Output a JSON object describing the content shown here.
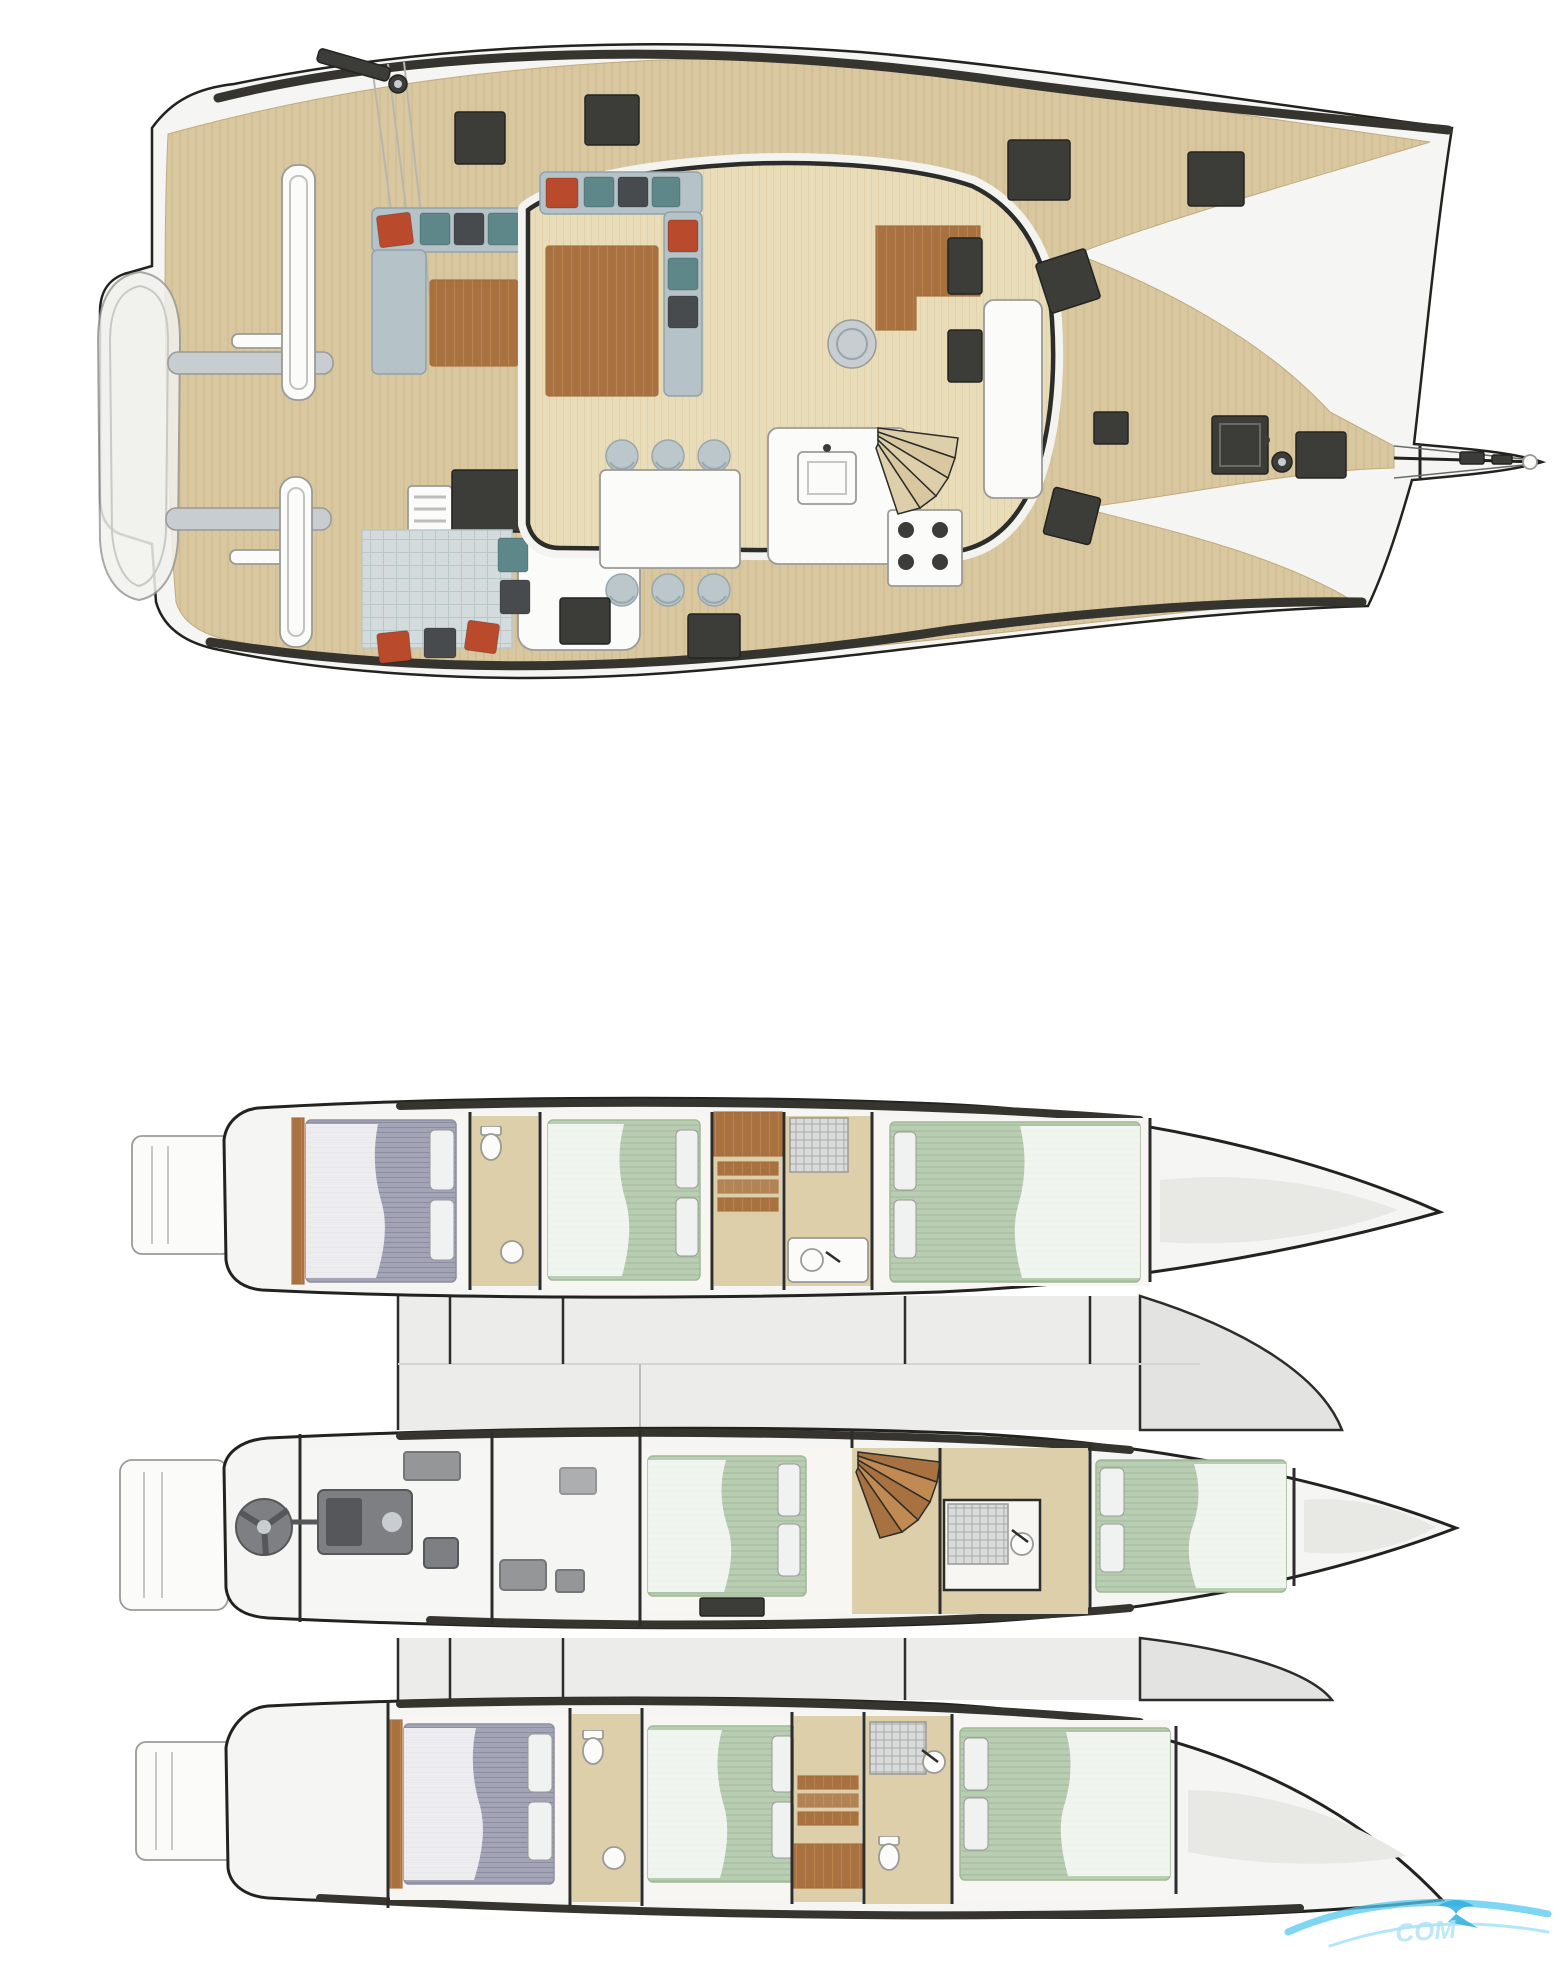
{
  "title": "Trimaran yacht layout — main deck and hull accommodation plans",
  "watermark": {
    "text": "COM"
  },
  "colors": {
    "page-bg": "#ffffff",
    "hull-fill": "#f5f5f3",
    "hull-line": "#22221f",
    "gunwale": "#35342f",
    "teak": "#d9c79f",
    "teak-line": "#c2ab7c",
    "saloon-floor": "#e9dcb9",
    "saloon-line": "#d6c598",
    "wing-fill": "#ececea",
    "wing-edge": "#e3e4e2",
    "roof-white": "#f3f3f0",
    "sofa": "#b5c3c9",
    "sofa-line": "#8fa3ac",
    "cushion-red": "#b94a2c",
    "cushion-teal": "#5d8788",
    "cushion-dark": "#474b4e",
    "wood": "#a87140",
    "wood-light": "#c08a52",
    "chair": "#bcc7cc",
    "chair-line": "#98a6ad",
    "white-fix": "#fbfbfa",
    "fix-line": "#9a9a96",
    "hatch": "#3c3c38",
    "hatch-line": "#23231f",
    "rug": "#d3dbdd",
    "rug-line": "#b9c6ca",
    "bed-green": "#b9cdb2",
    "bed-green-line": "#a0b998",
    "bed-gray": "#a3a4b6",
    "bed-gray-line": "#8c8da1",
    "pillow": "#f0f2f2",
    "floor-tan": "#dccfa9",
    "floor-white": "#f7f6f3",
    "engine": "#7d7f82",
    "engine-dark": "#55575a",
    "steel": "#c7cdd1",
    "dark-line": "#2c2c2a",
    "wm": "#54c8ef",
    "wm-text": "#aee3f6"
  },
  "main_deck": {
    "areas": [
      "aft-platform",
      "tender",
      "davits",
      "cockpit-lounge",
      "saloon",
      "galley",
      "navigation-station",
      "dining-area",
      "companionway-stairs",
      "foredeck",
      "trampoline-wings",
      "anchor-locker",
      "windlass",
      "bowsprit"
    ]
  },
  "lower_deck": {
    "hulls": [
      {
        "name": "port-hull",
        "spaces": [
          "stern-platform",
          "aft-double-cabin",
          "head",
          "mid-double-cabin",
          "dressing-steps",
          "shower-room",
          "fore-double-cabin",
          "bow-locker"
        ]
      },
      {
        "name": "center-hull",
        "spaces": [
          "stern-platform",
          "lazarette-steering",
          "engine-room",
          "technical-space",
          "owners-cabin",
          "staircase",
          "head-shower",
          "fore-cabin",
          "bow-locker"
        ]
      },
      {
        "name": "starboard-hull",
        "spaces": [
          "stern-platform",
          "aft-double-cabin",
          "head",
          "mid-double-cabin",
          "dressing-steps",
          "shower-room",
          "fore-double-cabin",
          "bow-locker"
        ]
      }
    ]
  }
}
